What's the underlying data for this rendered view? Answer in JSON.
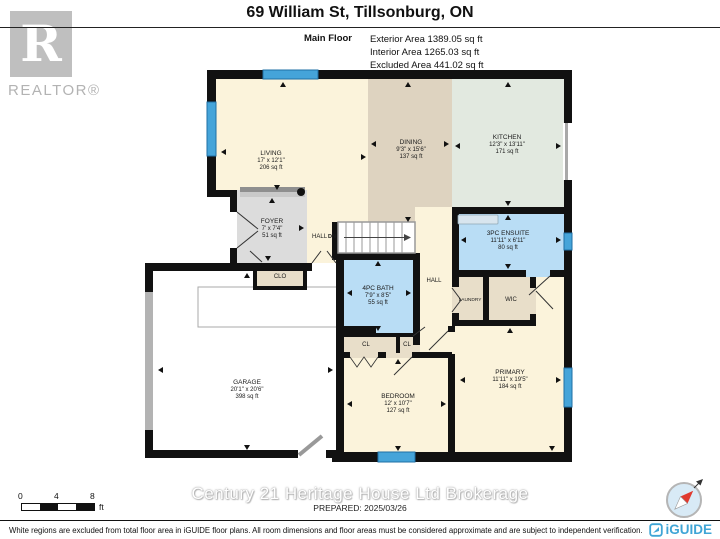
{
  "header": {
    "realtor_r": "R",
    "realtor_word": "REALTOR®",
    "title": "69 William St, Tillsonburg, ON",
    "floor_label": "Main Floor",
    "exterior": "Exterior Area 1389.05 sq ft",
    "interior": "Interior Area 1265.03 sq ft",
    "excluded": "Excluded Area 441.02 sq ft"
  },
  "rooms": {
    "living": {
      "name": "LIVING",
      "dims": "17' x 12'1\"",
      "area": "206 sq ft"
    },
    "dining": {
      "name": "DINING",
      "dims": "9'3\" x 15'6\"",
      "area": "137 sq ft"
    },
    "kitchen": {
      "name": "KITCHEN",
      "dims": "12'3\" x 13'11\"",
      "area": "171 sq ft"
    },
    "foyer": {
      "name": "FOYER",
      "dims": "7' x 7'4\"",
      "area": "51 sq ft"
    },
    "ensuite": {
      "name": "3PC ENSUITE",
      "dims": "11'11\" x 6'11\"",
      "area": "80 sq ft"
    },
    "bath": {
      "name": "4PC BATH",
      "dims": "7'9\" x 8'5\"",
      "area": "55 sq ft"
    },
    "garage": {
      "name": "GARAGE",
      "dims": "20'1\" x 20'6\"",
      "area": "398 sq ft"
    },
    "bedroom": {
      "name": "BEDROOM",
      "dims": "12' x 10'7\"",
      "area": "127 sq ft"
    },
    "primary": {
      "name": "PRIMARY",
      "dims": "11'11\" x 19'5\"",
      "area": "184 sq ft"
    }
  },
  "labels": {
    "hall_upper": "HALL",
    "dn": "DN",
    "hall_lower": "HALL",
    "clo": "CLO",
    "cl1": "CL",
    "cl2": "CL",
    "laundry": "LAUNDRY",
    "wic": "WIC"
  },
  "scale": {
    "t0": "0",
    "t4": "4",
    "t8": "8",
    "unit": "ft"
  },
  "watermark": "Century 21 Heritage House Ltd Brokerage",
  "prepared": "PREPARED: 2025/03/26",
  "footer": {
    "disclaimer": "White regions are excluded from total floor area in iGUIDE floor plans. All room dimensions and floor areas must be considered approximate and are subject to independent verification.",
    "brand": "iGUIDE"
  },
  "colors": {
    "wall": "#111111",
    "cream": "#FBF3DB",
    "dining_tan": "#DED3C0",
    "kitchen_green": "#E2E9E0",
    "room_blue": "#B9DDF5",
    "closet_tan": "#E8DEC9",
    "foyer_gray": "#DCDCDC",
    "window_blue": "#45A4D9",
    "brand_blue": "#3FA5D6",
    "compass_red": "#E03A2F"
  }
}
